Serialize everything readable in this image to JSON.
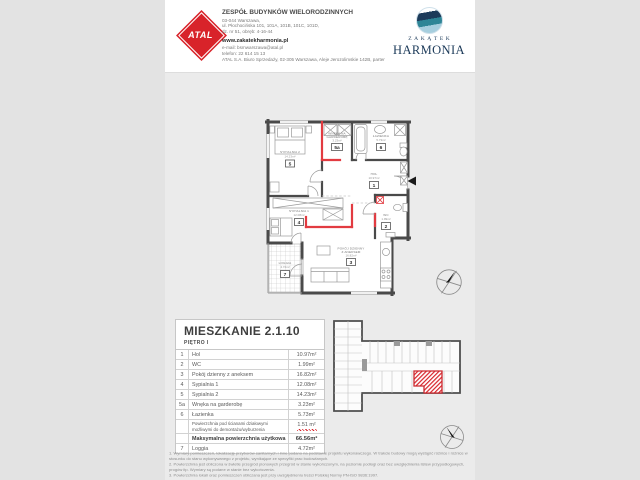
{
  "header": {
    "atal_logo": "ATAL",
    "project_type": "ZESPÓŁ BUDYNKÓW WIELORODZINNYCH",
    "address_line1": "03-044 Warszawa,",
    "address_line2": "ul. Płochocińska 101, 101A, 101B, 101C, 101D,",
    "address_line3": "dz. nr 51, obręb: 4-16-44",
    "website": "www.zakatekharmonia.pl",
    "email": "e-mail: bsmwarszawa@atal.pl",
    "phone": "telefon: 22 614 15 13",
    "sales_office": "ATAL S.A. Biuro Sprzedaży, 02-305 Warszawa, Aleje Jerozolimskie 142B, parter",
    "brand_top": "ZAKĄTEK",
    "brand_bottom": "HARMONIA"
  },
  "apartment": {
    "title": "MIESZKANIE 2.1.10",
    "floor": "PIĘTRO I"
  },
  "rooms_table": {
    "rows": [
      {
        "no": "1",
        "name": "Hol",
        "area": "10.97m²"
      },
      {
        "no": "2",
        "name": "WC",
        "area": "1.99m²"
      },
      {
        "no": "3",
        "name": "Pokój dzienny z aneksem",
        "area": "16.82m²"
      },
      {
        "no": "4",
        "name": "Sypialnia 1",
        "area": "12.08m²"
      },
      {
        "no": "5",
        "name": "Sypialnia 2",
        "area": "14.23m²"
      },
      {
        "no": "5a",
        "name": "Wnęka na garderobę",
        "area": "3.23m²"
      },
      {
        "no": "6",
        "name": "Łazienka",
        "area": "5.73m²"
      }
    ],
    "demolition": {
      "name": "Powierzchnia pod ścianami działowymi możliwymi do demontażu/wyburzenia",
      "area": "1.51 m²"
    },
    "total": {
      "name": "Maksymalna powierzchnia użytkowa",
      "area": "66.56m²"
    },
    "loggia": {
      "no": "7",
      "name": "Loggia",
      "area": "4.72m²"
    }
  },
  "floorplan": {
    "rooms": [
      {
        "no": "5",
        "name_lines": [
          "SYPIALNIA 2"
        ],
        "area": "14.23m²"
      },
      {
        "no": "5a",
        "name_lines": [
          "WNĘKA NA",
          "GARDEROBĘ"
        ],
        "area": "3.23m²"
      },
      {
        "no": "6",
        "name_lines": [
          "ŁAZIENKA"
        ],
        "area": "5.73m²"
      },
      {
        "no": "1",
        "name_lines": [
          "HOL"
        ],
        "area": "10.97m²"
      },
      {
        "no": "2",
        "name_lines": [
          "WC"
        ],
        "area": "1.99m²"
      },
      {
        "no": "4",
        "name_lines": [
          "SYPIALNIA 1"
        ],
        "area": "12.08m²"
      },
      {
        "no": "3",
        "name_lines": [
          "POKÓJ DZIENNY",
          "Z ANEKSEM"
        ],
        "area": "16.82m²"
      },
      {
        "no": "7",
        "name_lines": [
          "LOGGIA"
        ],
        "area": "4.72m²"
      }
    ]
  },
  "footnotes": [
    "1.  Wymiary pomieszczeń, lokalizację przyborów sanitarnych i inne podano na podstawie projektu wykonawczego. W trakcie budowy mogą wystąpić różnice i różnice w stosunku do stanu wykonywanego z projektu, wynikające ze specyfiki prac budowlanych.",
    "2.  Powierzchnia jest obliczona w świetle przegród pionowych przegród w stanie wykończonym, na poziomie podłogi oraz bez uwzględnienia listew przypodłogowych, progów itp. Wymiary są podane w stanie bez wykończenia.",
    "3.  Powierzchnia lokali oraz pomieszczeń obliczana jest przy uwzględnieniu treści Polskiej Normy PN-ISO 9836:1997."
  ],
  "colors": {
    "accent_red": "#d8232a",
    "wall_dark": "#4a4a4a",
    "brand_navy": "#1d3b5a",
    "brand_teal": "#2e8596",
    "brand_light_blue": "#a6cede"
  }
}
